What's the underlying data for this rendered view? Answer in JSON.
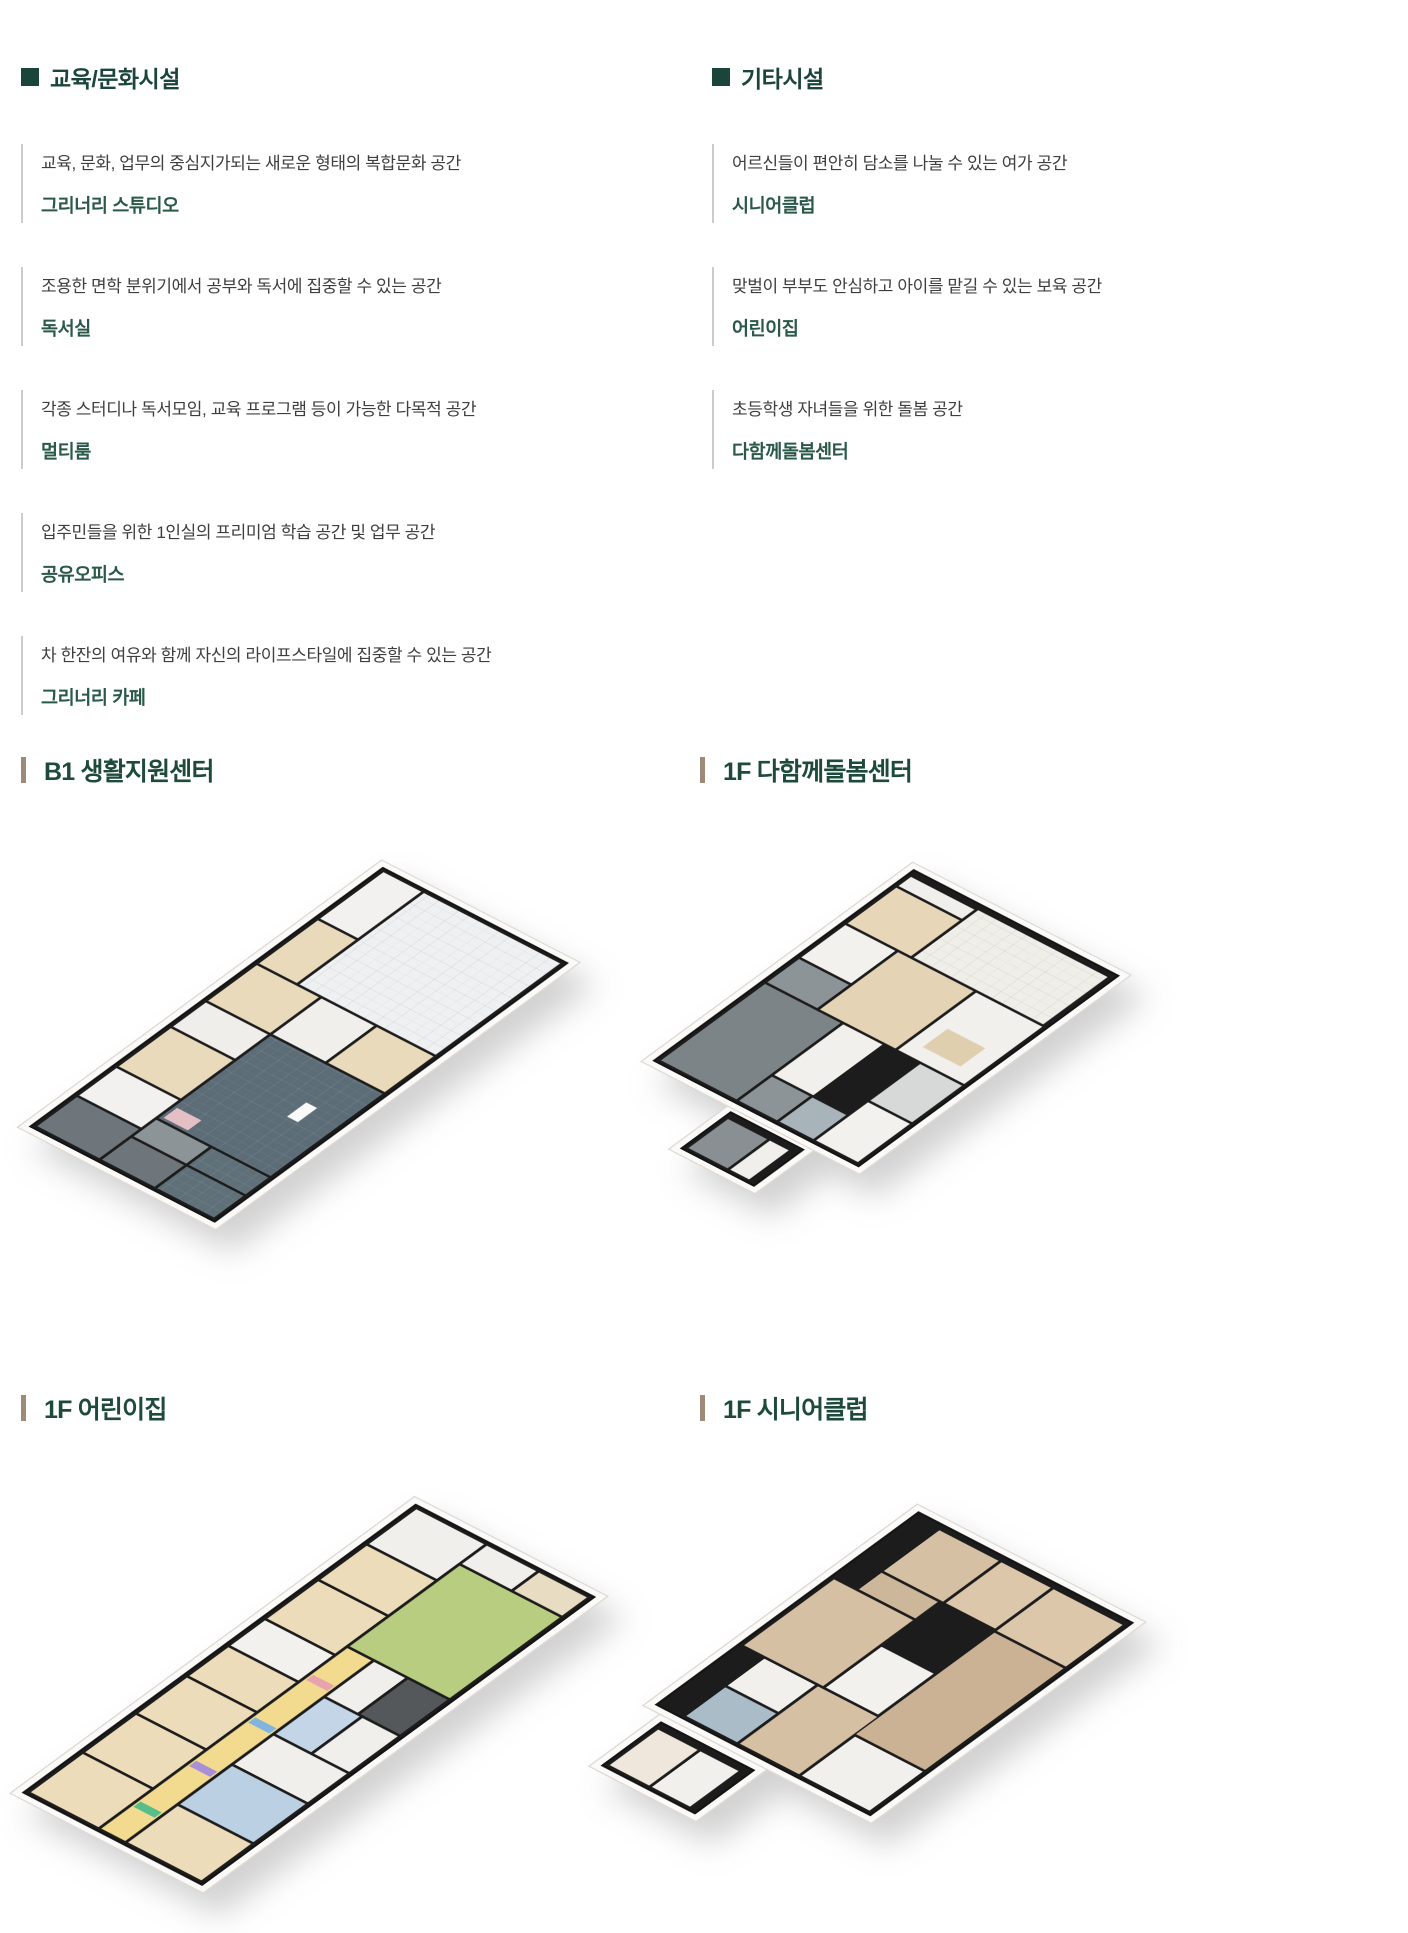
{
  "palette": {
    "heading_green": "#1b453a",
    "item_name_green": "#2a594a",
    "desc_gray": "#3d3f3e",
    "divider_gray": "#c9cecc",
    "title_bar_brown": "#9d8a79",
    "title_green": "#1e4a3c",
    "wall_black": "#1c1c1c",
    "slate_floor": "#5c6d78",
    "tile_white": "#eef0f1",
    "wood_light": "#ead9bb",
    "wood_mid": "#d6c0a3",
    "gray_room": "#7d8488",
    "green_play": "#b9cd81",
    "yellow_corridor": "#f2da8f",
    "blue_room": "#bcd0e4"
  },
  "sections": {
    "education": {
      "title": "교육/문화시설",
      "items": [
        {
          "desc": "교육, 문화, 업무의 중심지가되는 새로운 형태의 복합문화 공간",
          "name": "그리너리 스튜디오"
        },
        {
          "desc": "조용한 면학 분위기에서 공부와 독서에 집중할 수 있는 공간",
          "name": "독서실"
        },
        {
          "desc": "각종 스터디나 독서모임, 교육 프로그램 등이 가능한 다목적 공간",
          "name": "멀티룸"
        },
        {
          "desc": "입주민들을 위한 1인실의 프리미엄 학습 공간 및 업무 공간",
          "name": "공유오피스"
        },
        {
          "desc": "차 한잔의 여유와 함께 자신의 라이프스타일에 집중할 수 있는 공간",
          "name": "그리너리 카페"
        }
      ]
    },
    "other": {
      "title": "기타시설",
      "items": [
        {
          "desc": "어르신들이 편안히 담소를 나눌 수 있는 여가 공간",
          "name": "시니어클럽"
        },
        {
          "desc": "맞벌이 부부도 안심하고 아이를 맡길 수 있는 보육 공간",
          "name": "어린이집"
        },
        {
          "desc": "초등학생 자녀들을 위한 돌봄 공간",
          "name": "다함께돌봄센터"
        }
      ]
    }
  },
  "floorplans": [
    {
      "id": "b1-living-support-center",
      "title": "B1 생활지원센터"
    },
    {
      "id": "1f-dahamkke-care-center",
      "title": "1F 다함께돌봄센터"
    },
    {
      "id": "1f-daycare-center",
      "title": "1F 어린이집"
    },
    {
      "id": "1f-senior-club",
      "title": "1F 시니어클럽"
    }
  ]
}
